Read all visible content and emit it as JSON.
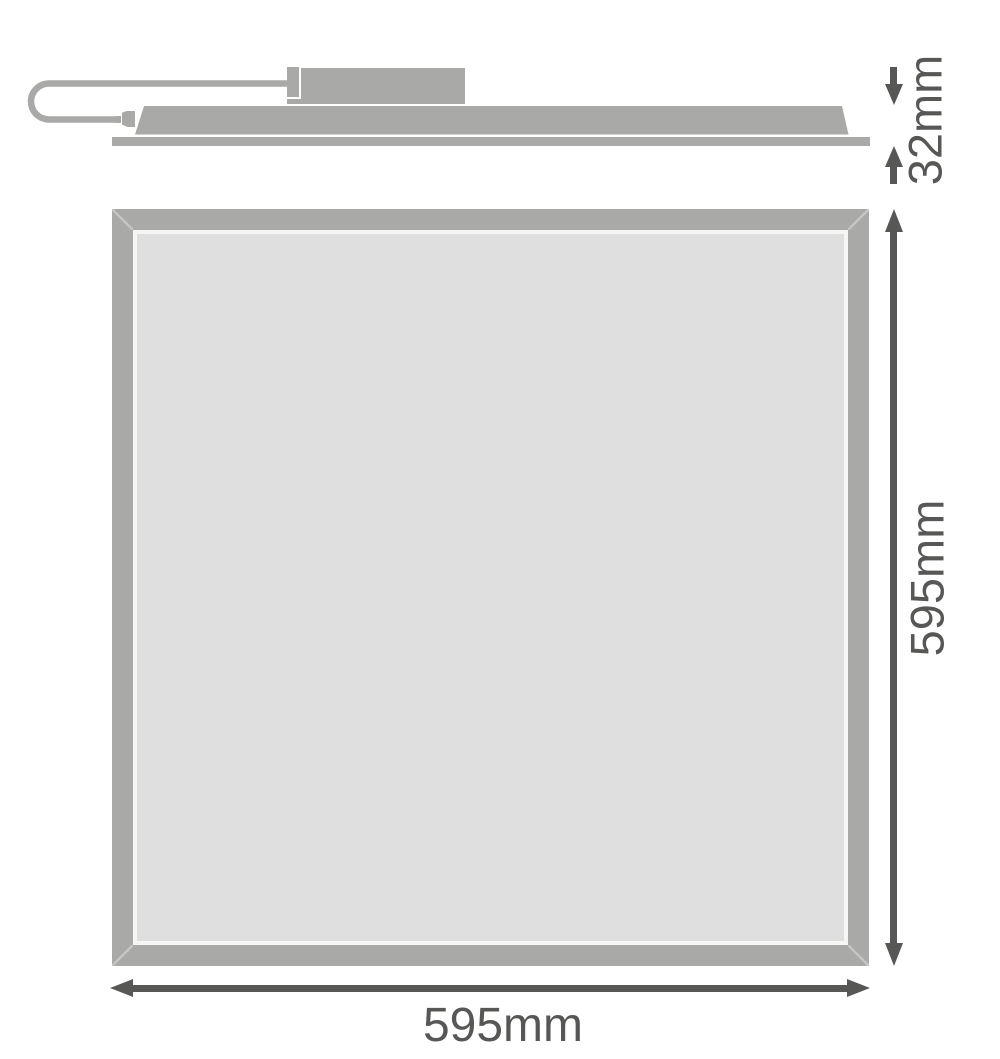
{
  "diagram": {
    "type": "technical-dimension-drawing",
    "subject": "LED flat panel luminaire with external driver and plug-in cable",
    "colors": {
      "outline_gray": "#a9a9a7",
      "panel_face_gray": "#dfdfdf",
      "inner_gap_white": "#f6f6f5",
      "dimension_dark": "#575756",
      "background": "#ffffff"
    },
    "side_view": {
      "height_label": "32mm"
    },
    "front_view": {
      "height_label": "595mm",
      "width_label": "595mm"
    }
  }
}
